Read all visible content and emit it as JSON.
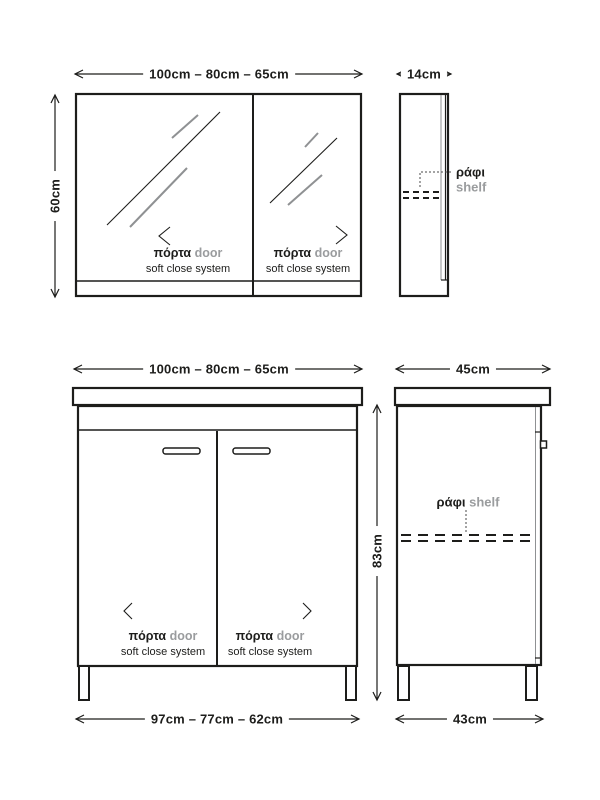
{
  "colors": {
    "ink": "#1d1d1b",
    "muted": "#9a9c9e",
    "background": "#ffffff"
  },
  "mirror_cabinet": {
    "front_view": {
      "width_dimension": "100cm – 80cm – 65cm",
      "height_dimension": "60cm",
      "left_door": {
        "label": "πόρτα",
        "label_en": "door",
        "feature": "soft close system"
      },
      "right_door": {
        "label": "πόρτα",
        "label_en": "door",
        "feature": "soft close system"
      }
    },
    "side_view": {
      "depth_dimension": "14cm",
      "shelf": {
        "label": "ράφι",
        "label_en": "shelf"
      }
    }
  },
  "vanity_cabinet": {
    "front_view": {
      "width_dimension": "100cm – 80cm – 65cm",
      "height_dimension": "83cm",
      "base_width_dimension": "97cm – 77cm – 62cm",
      "left_door": {
        "label": "πόρτα",
        "label_en": "door",
        "feature": "soft close system"
      },
      "right_door": {
        "label": "πόρτα",
        "label_en": "door",
        "feature": "soft close system"
      }
    },
    "side_view": {
      "top_depth_dimension": "45cm",
      "base_depth_dimension": "43cm",
      "shelf": {
        "label": "ράφι",
        "label_en": "shelf"
      }
    }
  }
}
